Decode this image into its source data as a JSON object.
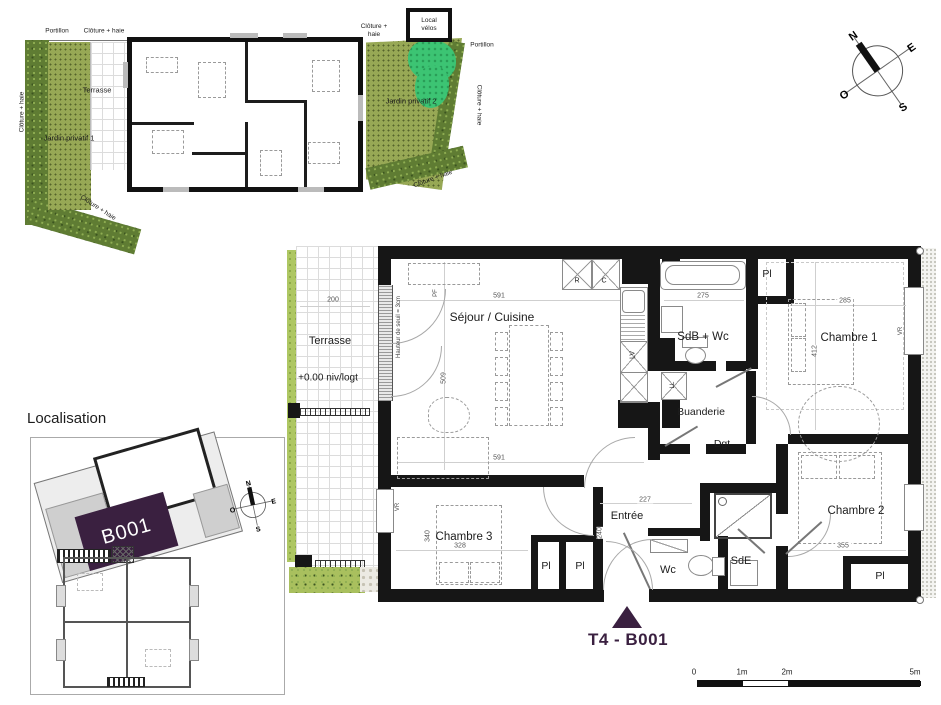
{
  "site": {
    "portillon_left": "Portillon",
    "cloture_top": "Clôture + haie",
    "cloture_left": "Clôture + haie",
    "cloture_bottom_left": "Clôture + haie",
    "terrasse": "Terrasse",
    "jardin1": "Jardin privatif 1",
    "jardin2": "Jardin privatif 2",
    "local_velos": "Local vélos",
    "cloture_right_top": "Clôture + haie",
    "portillon_right": "Portillon",
    "cloture_right": "Clôture + haie",
    "cloture_bottom_right": "Clôture + haie"
  },
  "compass": {
    "n": "N",
    "e": "E",
    "s": "S",
    "o": "O"
  },
  "plan": {
    "rooms": {
      "sejour": "Séjour / Cuisine",
      "sdb": "SdB + Wc",
      "chambre1": "Chambre 1",
      "buanderie": "Buanderie",
      "dgt": "Dgt",
      "chambre2": "Chambre 2",
      "chambre3": "Chambre 3",
      "entree": "Entrée",
      "wc": "Wc",
      "sde": "SdE",
      "pl": "Pl"
    },
    "terrace": {
      "label": "Terrasse",
      "level": "+0.00 niv/logt"
    },
    "appliances": {
      "fridge": "R",
      "oven": "C",
      "dishwasher": "LV",
      "washer": "LL"
    },
    "notes": {
      "seuil": "Hauteur de seuil = 3cm",
      "pf": "PF",
      "vr": "VR"
    },
    "dims": {
      "terrace_w": "200",
      "sejour_w": "591",
      "sejour_h": "509",
      "sejour_w2": "591",
      "sdb_w": "275",
      "ch1_w": "285",
      "ch1_h": "412",
      "ch2_w": "355",
      "ch3_w": "328",
      "ch3_h": "340",
      "entree_w": "227",
      "entree_h": "240"
    }
  },
  "localisation": {
    "title": "Localisation",
    "unit": "B001"
  },
  "marker": {
    "unit": "T4 - B001"
  },
  "scalebar": {
    "t0": "0",
    "t1": "1m",
    "t2": "2m",
    "t5": "5m"
  },
  "colors": {
    "accent_purple": "#3a2040",
    "garden_green": "#97a855",
    "hedge_green": "#5f7c33",
    "bush_green": "#3cc473",
    "terrace_green": "#aec763",
    "wall_black": "#161616"
  }
}
